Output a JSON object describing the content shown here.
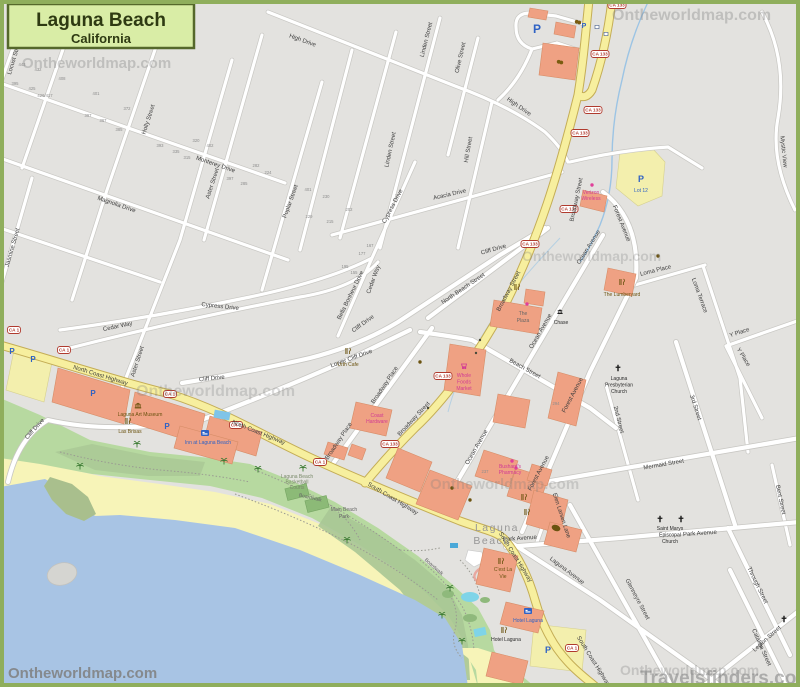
{
  "title": {
    "name": "Laguna Beach",
    "state": "California"
  },
  "watermarks": {
    "site": "Ontheworldmap.com",
    "travel": "Travelsfinders.com"
  },
  "shields": {
    "ca1": "CA 1",
    "ca133": "CA 133"
  },
  "parking": {
    "p": "P",
    "lot12": "Lot 12"
  },
  "city_label": {
    "line1": "Laguna",
    "line2": "Beach"
  },
  "streets": {
    "high_drive": "High Drive",
    "locust_street": "Locust Street",
    "holly_street": "Holly Street",
    "monterey_drive": "Monterey Drive",
    "aster_street": "Aster Street",
    "magnolia_drive": "Magnolia Drive",
    "jasmine_street": "Jasmine Street",
    "poplar_street": "Poplar Street",
    "linden_street": "Linden Street",
    "olive_street": "Olive Street",
    "hill_street": "Hill Street",
    "acacia_drive": "Acacia Drive",
    "cypress_drive": "Cypress Drive",
    "cedar_way": "Cedar Way",
    "cliff_drive": "Cliff Drive",
    "lower_cliff_drive": "Lower Cliff Drive",
    "bella_bonheur_drive": "Bella Bonheur Drive",
    "north_coast_highway": "North Coast Highway",
    "south_coast_highway": "South Coast Highway",
    "broadway_street": "Broadway Street",
    "broadway_place": "Broadway Place",
    "north_beach_street": "North Beach Street",
    "beach_street": "Beach Street",
    "ocean_avenue": "Ocean Avenue",
    "forest_avenue": "Forest Avenue",
    "loma_place": "Loma Place",
    "loma_terrace": "Loma Terrace",
    "y_place": "Y Place",
    "second_street": "2nd Street",
    "third_street": "3rd Street",
    "mermaid_street": "Mermaid Street",
    "park_avenue": "Park Avenue",
    "laguna_avenue": "Laguna Avenue",
    "glenneyre_street": "Glenneyre Street",
    "through_street": "Through Street",
    "catalina_street": "Catalina Street",
    "legion_street": "Legion Street",
    "bent_street": "Bent Street",
    "elen_larsen_lane": "Elen Larsen Lane",
    "mystic_view": "Mystic View"
  },
  "pois": {
    "urth_cafe": "Urth Cafe",
    "laguna_art_museum": "Laguna Art Museum",
    "las_brisas": "Las Brisas",
    "inn_at_laguna_beach": "Inn at Laguna Beach",
    "chase": "Chase",
    "the_plaza": [
      "The",
      "Plaza"
    ],
    "the_lumberyard": "The Lumberyard",
    "verizon": [
      "Verizon",
      "Wireless"
    ],
    "whole_foods": [
      "Whole",
      "Foods",
      "Market"
    ],
    "coast_hardware": [
      "Coast",
      "Hardware"
    ],
    "bushards_pharmacy": [
      "Bushard's",
      "Pharmacy"
    ],
    "presbyterian": [
      "Laguna",
      "Presbyterian",
      "Church"
    ],
    "st_marys": [
      "Saint Marys",
      "Episcopal",
      "Church"
    ],
    "cest_la_vie": [
      "C'est La",
      "Vie"
    ],
    "hotel_laguna": "Hotel Laguna",
    "main_beach_park": [
      "Main Beach",
      "Park"
    ],
    "boardwalk": "Boardwalk",
    "courts": [
      "Laguna Beach",
      "Basketball",
      "Courts"
    ]
  },
  "house_numbers": [
    "443",
    "432",
    "408",
    "395",
    "425",
    "426/417",
    "401",
    "372",
    "397",
    "367",
    "385",
    "393",
    "335",
    "315",
    "320",
    "402",
    "282",
    "397",
    "285",
    "224",
    "401",
    "230",
    "202",
    "229",
    "215",
    "167",
    "177",
    "195",
    "155",
    "294",
    "237"
  ]
}
